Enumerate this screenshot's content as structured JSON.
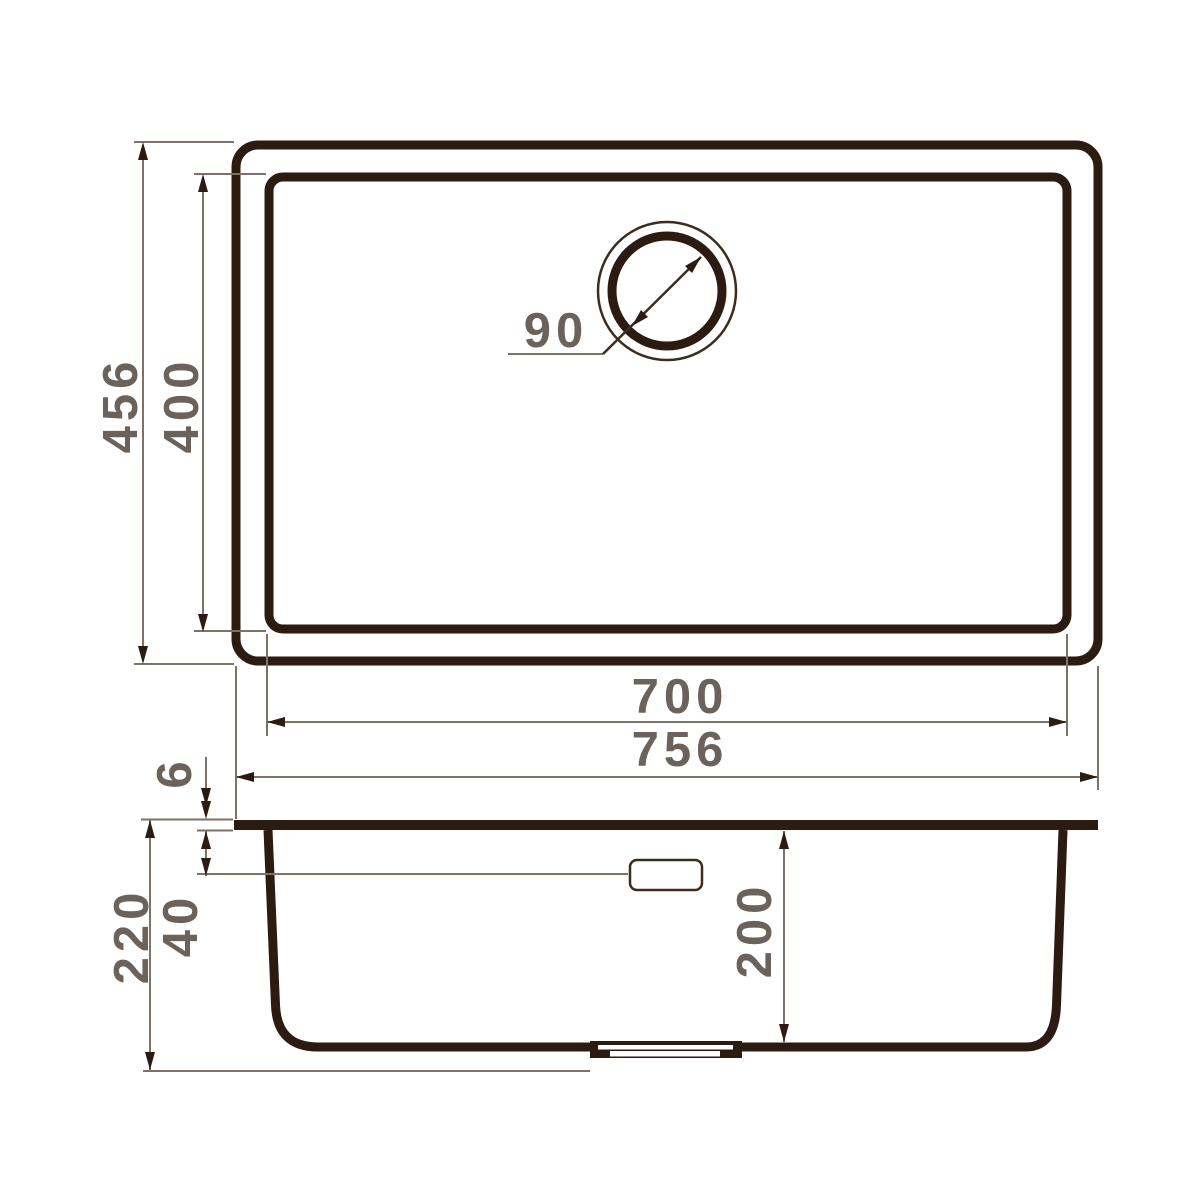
{
  "colors": {
    "background": "#ffffff",
    "outline_dark": "#2b1b10",
    "outline_medium": "#3c2c1e",
    "dimension_line": "#7d7268",
    "dimension_text": "#6b635b"
  },
  "top_view": {
    "outer_width": "756",
    "inner_width": "700",
    "outer_depth": "456",
    "inner_depth": "400",
    "drain_diameter": "90"
  },
  "side_view": {
    "total_height": "220",
    "rim_thickness": "6",
    "overflow_depth": "40",
    "bowl_depth": "200"
  }
}
